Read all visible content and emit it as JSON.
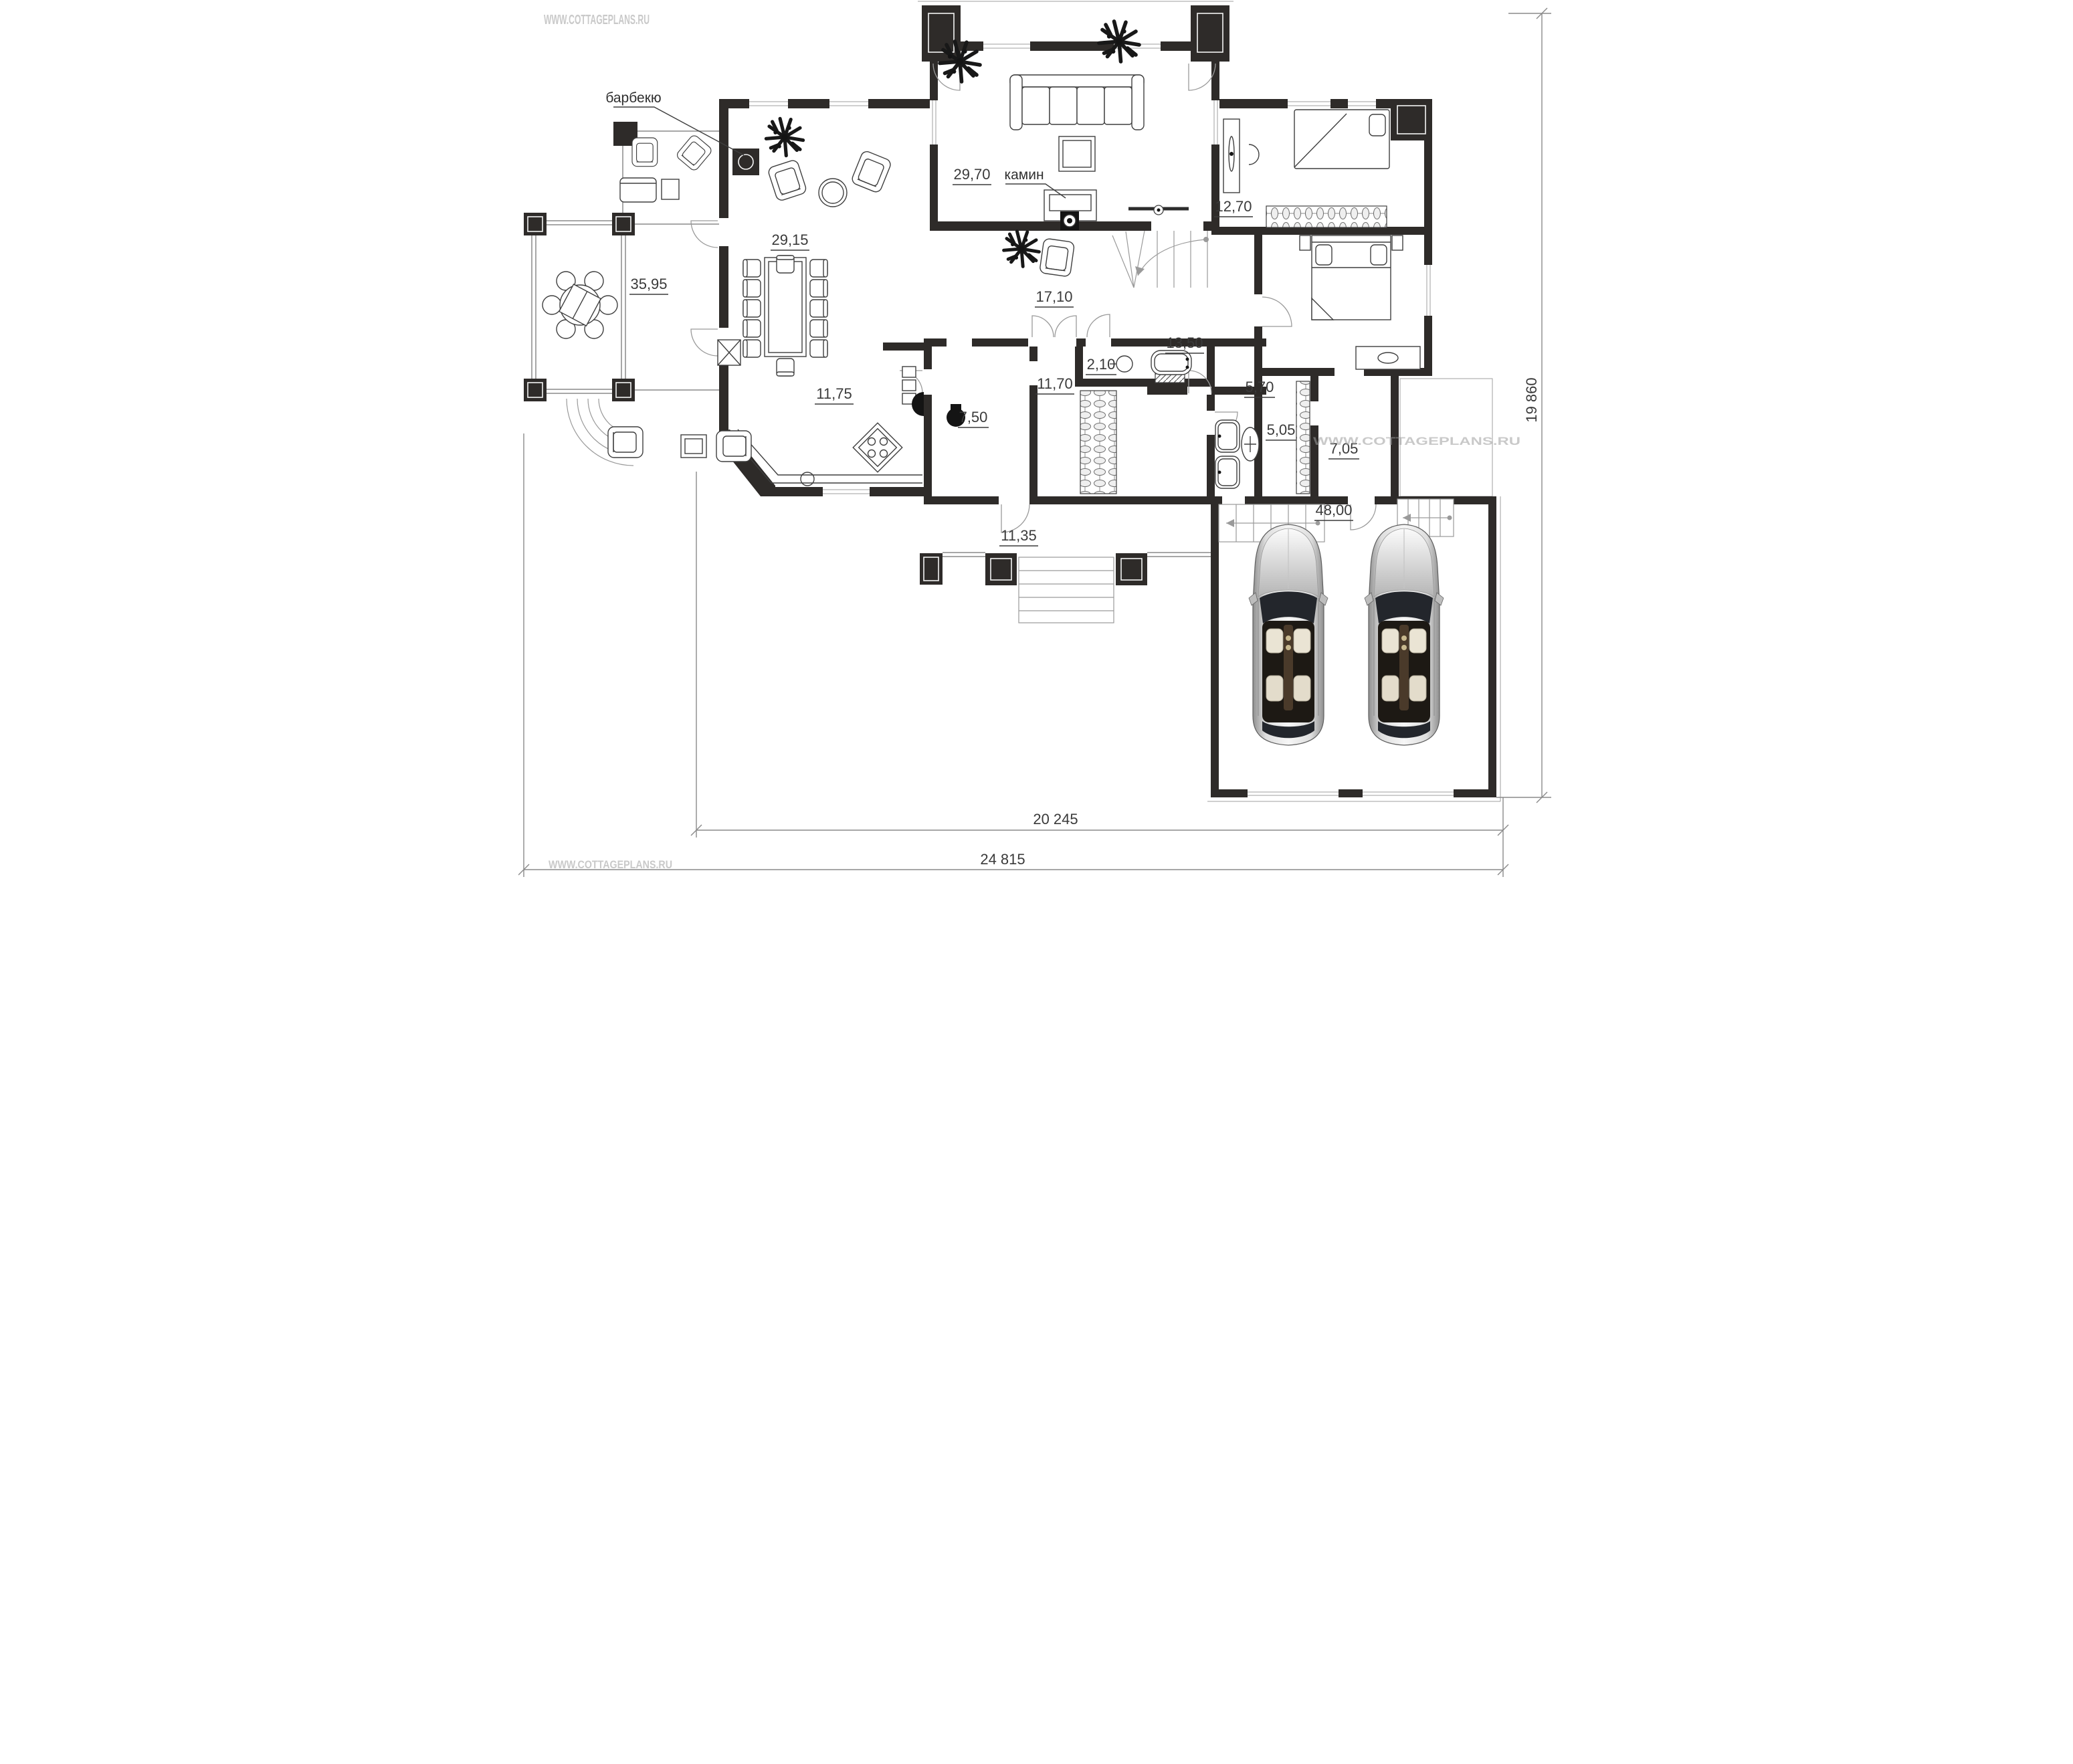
{
  "watermark": {
    "text": "WWW.COTTAGEPLANS.RU"
  },
  "callouts": {
    "barbecue": "барбекю",
    "fireplace": "камин"
  },
  "room_areas": {
    "music_room": "29,70",
    "study": "12,70",
    "living_dining": "29,15",
    "gazebo_terrace": "35,95",
    "hall": "17,10",
    "bedroom": "13,50",
    "wc": "2,10",
    "kitchen": "11,75",
    "utility": "11,70",
    "pantry": "7,50",
    "bathroom": "5,70",
    "corridor": "5,05",
    "entry": "7,05",
    "south_terrace": "11,35",
    "garage": "48,00"
  },
  "dimensions": {
    "inner_width": "20 245",
    "outer_width": "24 815",
    "right_height": "19 860"
  },
  "colors": {
    "wall": "#2e2b29",
    "dimension_line": "#8a8a8a",
    "watermark": "#c9c9c9",
    "label": "#3a3a3a"
  }
}
